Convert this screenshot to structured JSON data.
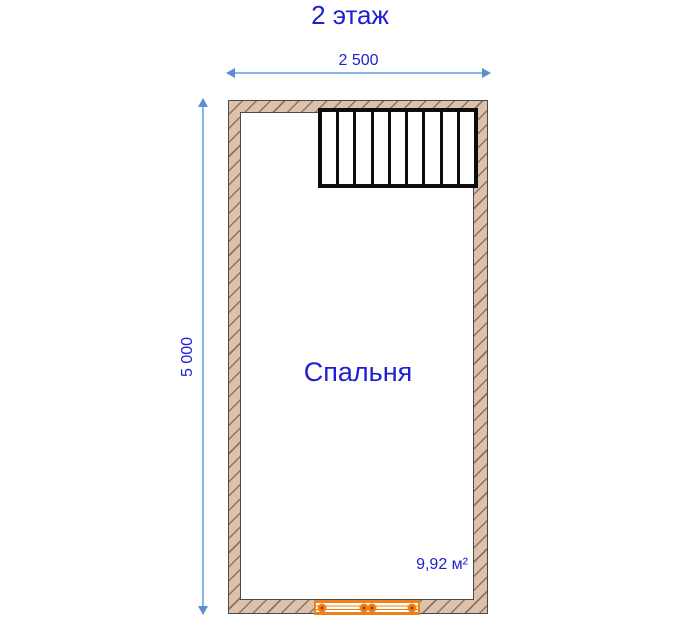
{
  "title": "2 этаж",
  "dimensions": {
    "width_label": "2 500",
    "height_label": "5 000"
  },
  "room": {
    "name": "Спальня",
    "area": "9,92 м²"
  },
  "stairs": {
    "steps": 9
  },
  "colors": {
    "text_blue": "#1e1ed2",
    "dim_line": "#85b8e8",
    "dim_arrow": "#5b8fd0",
    "wall_fill": "#dcc2ac",
    "wall_hatch": "#8d7260",
    "wall_outline": "#4a4a4a",
    "stairs_color": "#0d0d0d",
    "window_orange": "#f08018"
  }
}
